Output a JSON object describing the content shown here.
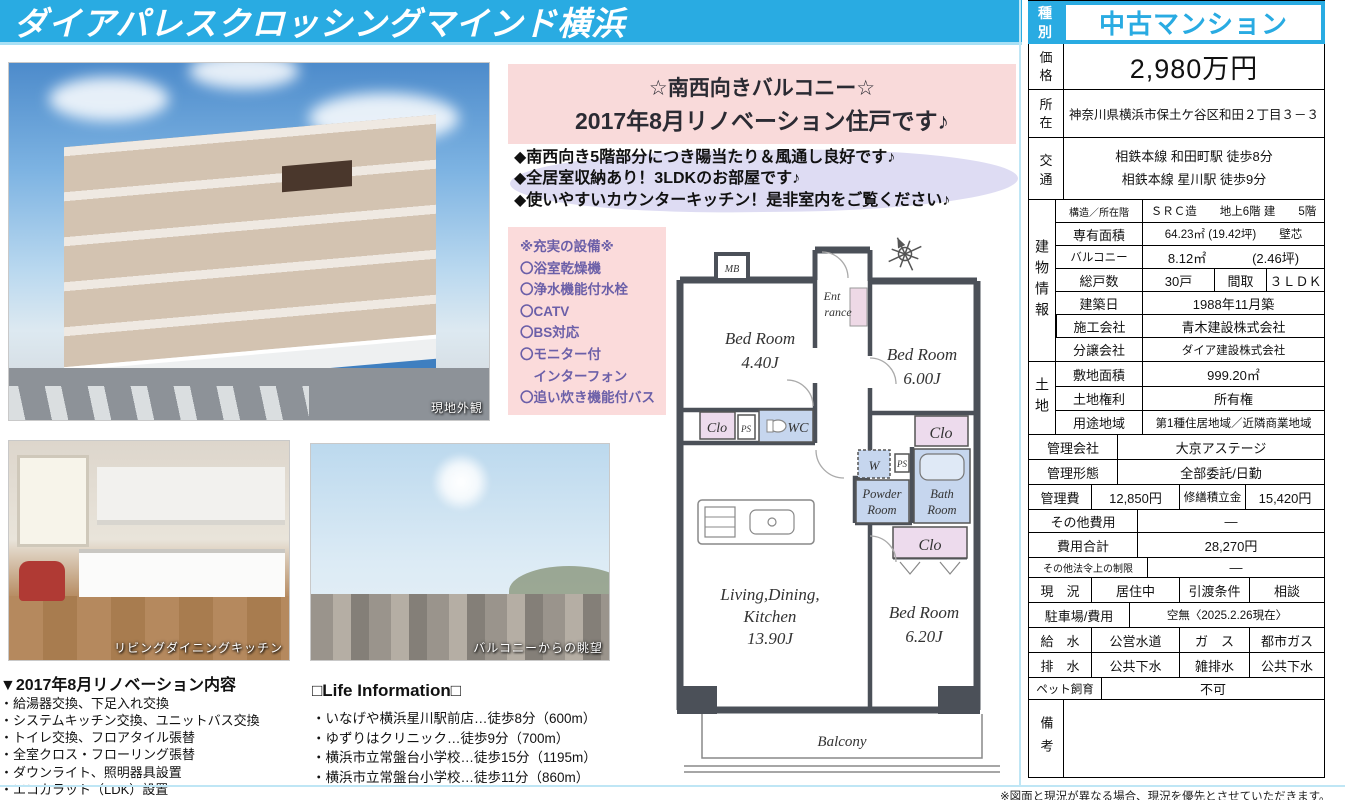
{
  "header": {
    "title": "ダイアパレスクロッシングマインド横浜"
  },
  "callout": {
    "line1": "☆南西向きバルコニー☆",
    "line2": "2017年8月リノベーション住戸です♪"
  },
  "highlights": [
    "◆南西向き5階部分につき陽当たり＆風通し良好です♪",
    "◆全居室収納あり！3LDKのお部屋です♪",
    "◆使いやすいカウンターキッチン！是非室内をご覧ください♪"
  ],
  "equipment": {
    "title": "※充実の設備※",
    "items": [
      "〇浴室乾燥機",
      "〇浄水機能付水栓",
      "〇CATV",
      "〇BS対応",
      "〇モニター付",
      "　インターフォン",
      "〇追い炊き機能付バス"
    ]
  },
  "photos": {
    "exterior_caption": "現地外観",
    "kitchen_caption": "リビングダイニングキッチン",
    "view_caption": "バルコニーからの眺望"
  },
  "renovation": {
    "title": "▼2017年8月リノベーション内容",
    "items": [
      "・給湯器交換、下足入れ交換",
      "・システムキッチン交換、ユニットバス交換",
      "・トイレ交換、フロアタイル張替",
      "・全室クロス・フローリング張替",
      "・ダウンライト、照明器具設置",
      "・エコカラット（LDK）設置"
    ]
  },
  "life_info": {
    "title": "□Life Information□",
    "items": [
      "・いなげや横浜星川駅前店…徒歩8分（600m）",
      "・ゆずりはクリニック…徒歩9分（700m）",
      "・横浜市立常盤台小学校…徒歩15分（1195m）",
      "・横浜市立常盤台小学校…徒歩11分（860m）"
    ]
  },
  "floorplan": {
    "mb": "MB",
    "ent1": "Ent",
    "ent2": "rance",
    "bed1_name": "Bed Room",
    "bed1_size": "4.40J",
    "bed2_name": "Bed Room",
    "bed2_size": "6.00J",
    "bed3_name": "Bed Room",
    "bed3_size": "6.20J",
    "ldk1": "Living,Dining,",
    "ldk2": "Kitchen",
    "ldk3": "13.90J",
    "clo": "Clo",
    "ps": "PS",
    "wc": "WC",
    "w": "W",
    "powder1": "Powder",
    "powder2": "Room",
    "bath1": "Bath",
    "bath2": "Room",
    "balcony": "Balcony"
  },
  "table": {
    "type": {
      "label": "種別",
      "value": "中古マンション"
    },
    "price": {
      "label": "価格",
      "value": "2,980万円"
    },
    "location": {
      "label": "所在",
      "value": "神奈川県横浜市保土ケ谷区和田２丁目３－３"
    },
    "access": {
      "label": "交通",
      "line1": "相鉄本線 和田町駅 徒歩8分",
      "line2": "相鉄本線 星川駅 徒歩9分"
    },
    "building": {
      "group": "建物情報",
      "structure": {
        "label": "構造／所在階",
        "value": "ＳＲＣ造　　地上6階 建　　5階"
      },
      "area": {
        "label": "専有面積",
        "value": "64.23㎡ (19.42坪)　　壁芯"
      },
      "balcony": {
        "label": "バルコニー",
        "value": "8.12㎡",
        "value2": "(2.46坪)"
      },
      "units": {
        "label": "総戸数",
        "value": "30戸",
        "label2": "間取",
        "value2": "３ＬＤＫ"
      },
      "built": {
        "label": "建築日",
        "value": "1988年11月築"
      },
      "constructor": {
        "label": "施工会社",
        "value": "青木建設株式会社"
      },
      "developer": {
        "label": "分譲会社",
        "value": "ダイア建設株式会社"
      }
    },
    "land": {
      "group": "土地",
      "site_area": {
        "label": "敷地面積",
        "value": "999.20㎡"
      },
      "rights": {
        "label": "土地権利",
        "value": "所有権"
      },
      "zoning": {
        "label": "用途地域",
        "value": "第1種住居地域／近隣商業地域"
      }
    },
    "mgmt_company": {
      "label": "管理会社",
      "value": "大京アステージ"
    },
    "mgmt_type": {
      "label": "管理形態",
      "value": "全部委託/日勤"
    },
    "mgmt_fee": {
      "label": "管理費",
      "value": "12,850円",
      "label2": "修繕積立金",
      "value2": "15,420円"
    },
    "other_fee": {
      "label": "その他費用",
      "value": "—"
    },
    "total_fee": {
      "label": "費用合計",
      "value": "28,270円"
    },
    "legal": {
      "label": "その他法令上の制限",
      "value": "—"
    },
    "status": {
      "label": "現　況",
      "value": "居住中",
      "label2": "引渡条件",
      "value2": "相談"
    },
    "parking": {
      "label": "駐車場/費用",
      "value": "空無〈2025.2.26現在〉"
    },
    "water": {
      "label": "給　水",
      "value": "公営水道",
      "label2": "ガ　ス",
      "value2": "都市ガス"
    },
    "sewage": {
      "label": "排　水",
      "value": "公共下水",
      "label2": "雑排水",
      "value2": "公共下水"
    },
    "pets": {
      "label": "ペット飼育",
      "value": "不可"
    },
    "notes": {
      "label": "備考",
      "value": ""
    }
  },
  "footnote": "※図面と現況が異なる場合、現況を優先とさせていただきます。",
  "colors": {
    "accent_blue": "#29abe2",
    "callout_pink": "#f9dada",
    "highlight_lavender": "#dedcf3",
    "plan_wet_blue": "#c6d6ee",
    "plan_closet_pink": "#eddbed",
    "wall_gray": "#4b5058"
  }
}
